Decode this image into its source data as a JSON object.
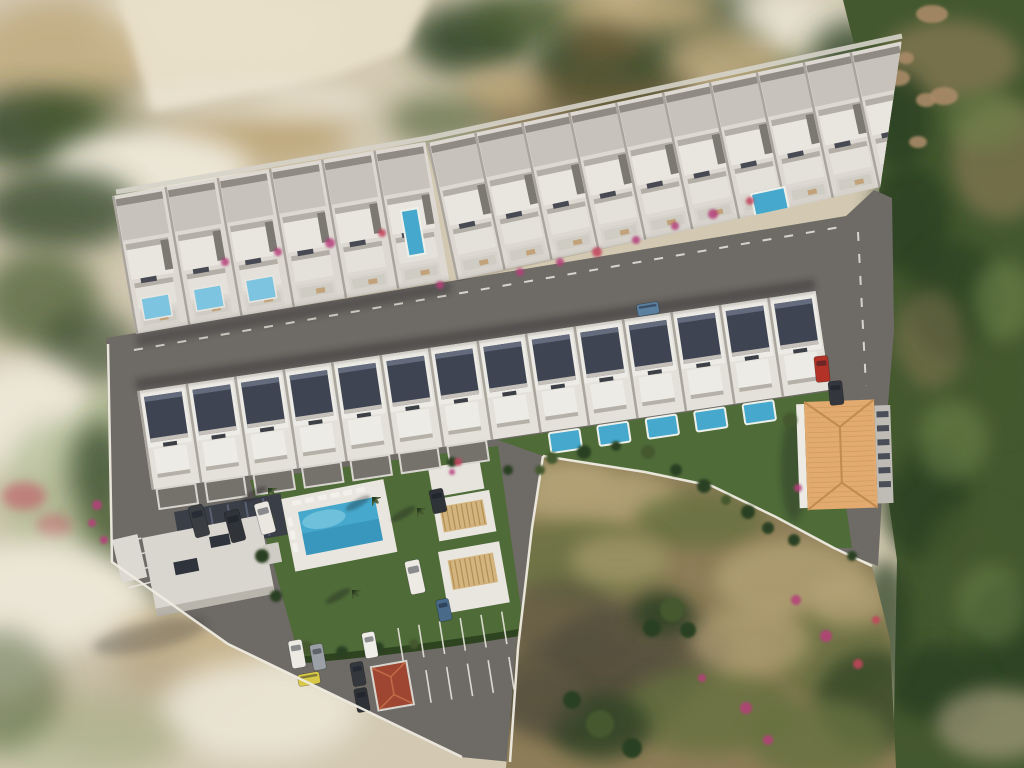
{
  "scene": {
    "description": "Aerial 3D render of a hillside residential development: an arc of white townhouses, a row of villas with private pools, a communal pool with sun loungers, clubhouse, parking with cars, an orange hip-roofed building and a dry vacant plot surrounded by scrubland and trees"
  },
  "palette": {
    "sand_base": "#d3c9b2",
    "sand_light": "#ece6d6",
    "sand_dark": "#b2a689",
    "scrub_top": "#bfa97d",
    "scrub_dark": "#6b5a35",
    "green_dark": "#2c4023",
    "green_mid": "#44582f",
    "green_light": "#6f854c",
    "green_pale": "#a8b58c",
    "rock": "#a98a68",
    "asphalt": "#6e6a65",
    "asphalt_dark": "#5a5651",
    "lane_line": "#e9e6de",
    "wall_white": "#ddd9d2",
    "wall_bright": "#edebe5",
    "wall_shadow": "#8f8b84",
    "roof_gray": "#c7c3bc",
    "roof_dark": "#3e4452",
    "roof_ridge": "#636b7c",
    "pool_blue": "#45a8cc",
    "pool_light": "#7cc4e0",
    "lawn": "#4f6b38",
    "hedge": "#2e431f",
    "lot_base": "#8d7d58",
    "lot_olive": "#66713f",
    "lot_tan": "#b3a276",
    "lot_shadow": "#55503c",
    "orange_roof": "#e2aa6e",
    "orange_ridge": "#c08b4e",
    "terracotta": "#9e4631",
    "flower_pink": "#b5407a",
    "flower_red": "#c2455c"
  },
  "development": {
    "top_row": {
      "left_units": 6,
      "right_units": 10,
      "terrace_pools": 2,
      "front_plunge_pools": 3
    },
    "middle_row": {
      "units": 14,
      "private_pools": 5
    },
    "amenities": {
      "communal_pools": 1,
      "communal_sun_loungers": 9,
      "roof_terrace_loungers": 6,
      "orange_roof_buildings": 1,
      "clubhouses": 1,
      "terracotta_kiosks": 1
    },
    "parking": {
      "marked_stall_rows": 2,
      "stalls_per_row": 5
    },
    "vehicles": [
      {
        "name": "red-car",
        "color": "#b23227"
      },
      {
        "name": "dark-car-entrance",
        "color": "#33363c"
      },
      {
        "name": "white-van-amenity",
        "color": "#eceae3"
      },
      {
        "name": "blue-car-amenity",
        "color": "#4a6a8a"
      },
      {
        "name": "dark-car-amenity",
        "color": "#2f3338"
      },
      {
        "name": "dark-van-1",
        "color": "#3a3d42"
      },
      {
        "name": "dark-van-2",
        "color": "#303338"
      },
      {
        "name": "white-van-2",
        "color": "#e9e7e0"
      },
      {
        "name": "white-van-parking",
        "color": "#eceae3"
      },
      {
        "name": "gray-car-parking",
        "color": "#9aa0a6"
      },
      {
        "name": "yellow-car-parking",
        "color": "#d8c84a"
      },
      {
        "name": "white-car-parking",
        "color": "#f0eee8"
      },
      {
        "name": "dark-car-parking-1",
        "color": "#34373c"
      },
      {
        "name": "dark-car-parking-2",
        "color": "#2e3136"
      },
      {
        "name": "blue-car-road",
        "color": "#5b7f9e"
      }
    ]
  }
}
